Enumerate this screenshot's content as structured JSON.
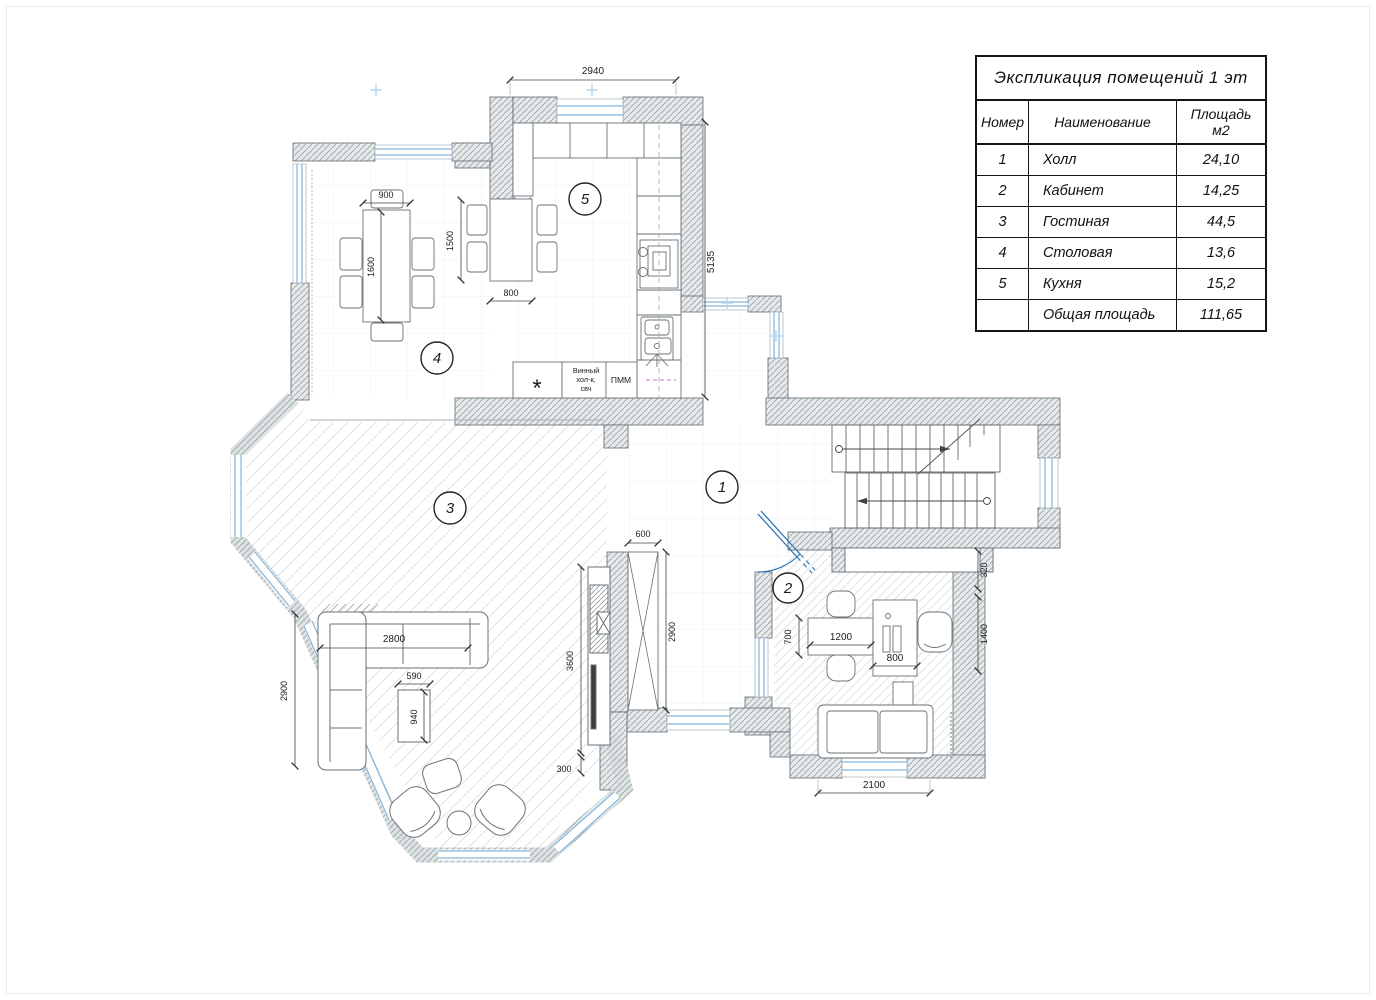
{
  "legend": {
    "title": "Экспликация помещений 1 эт",
    "col_number": "Номер",
    "col_name": "Наименование",
    "col_area_1": "Площадь",
    "col_area_2": "м2",
    "rows": [
      {
        "num": "1",
        "name": "Холл",
        "area": "24,10"
      },
      {
        "num": "2",
        "name": "Кабинет",
        "area": "14,25"
      },
      {
        "num": "3",
        "name": "Гостиная",
        "area": "44,5"
      },
      {
        "num": "4",
        "name": "Столовая",
        "area": "13,6"
      },
      {
        "num": "5",
        "name": "Кухня",
        "area": "15,2"
      },
      {
        "num": "",
        "name": "Общая площадь",
        "area": "111,65"
      }
    ]
  },
  "plan": {
    "rooms": {
      "hall": "1",
      "office": "2",
      "living": "3",
      "dining": "4",
      "kitchen": "5"
    },
    "dims": {
      "kitchen_top": "2940",
      "kitchen_right": "5135",
      "dining_table_w": "900",
      "dining_table_l": "1600",
      "bar_table_l": "1500",
      "bar_table_w": "800",
      "closet_w": "600",
      "closet_h": "2900",
      "media_wall": "3600",
      "media_offset": "300",
      "sofa_len": "2800",
      "sofa_side": "2900",
      "coffee_w": "590",
      "coffee_l": "940",
      "office_table_dep": "700",
      "office_table_len": "1200",
      "desk_w": "800",
      "office_gap": "320",
      "office_win_side": "1400",
      "office_win": "2100"
    },
    "labels": {
      "wine_1": "Винный",
      "wine_2": "хол-к,",
      "wine_3": "свч",
      "dishwasher": "ПММ",
      "fridge_star": "*"
    },
    "colors": {
      "window": "#85b3d9",
      "door": "#2e75b6",
      "wall_line": "#5f6a70",
      "utility_dash": "#cf8fd0"
    }
  }
}
